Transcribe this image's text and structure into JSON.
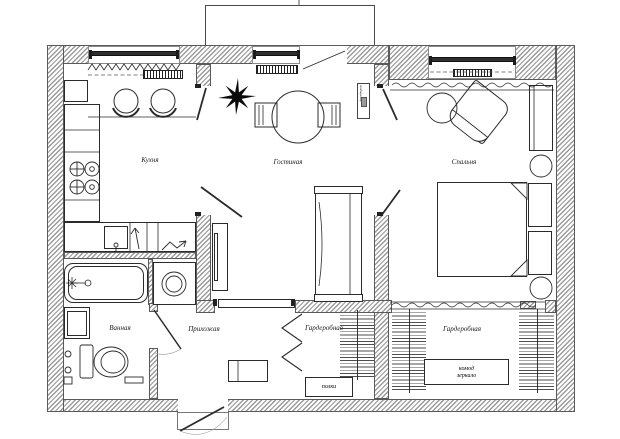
{
  "plan": {
    "rooms": {
      "kitchen": "Кухня",
      "living_room": "Гостиная",
      "bedroom": "Спальня",
      "bathroom": "Ванная",
      "hallway": "Прихожая",
      "wardrobe_1": "Гардеробная",
      "wardrobe_2": "Гардеробная"
    },
    "annotations": {
      "shelves": "полки",
      "dresser": "комод",
      "mirror": "зеркало",
      "ac_unit": "кондиционер"
    },
    "colors": {
      "line": "#2b2b2b",
      "wall_hatch": "#9a9a9a",
      "background": "#ffffff",
      "star_decor": "#0a0a0a"
    }
  }
}
